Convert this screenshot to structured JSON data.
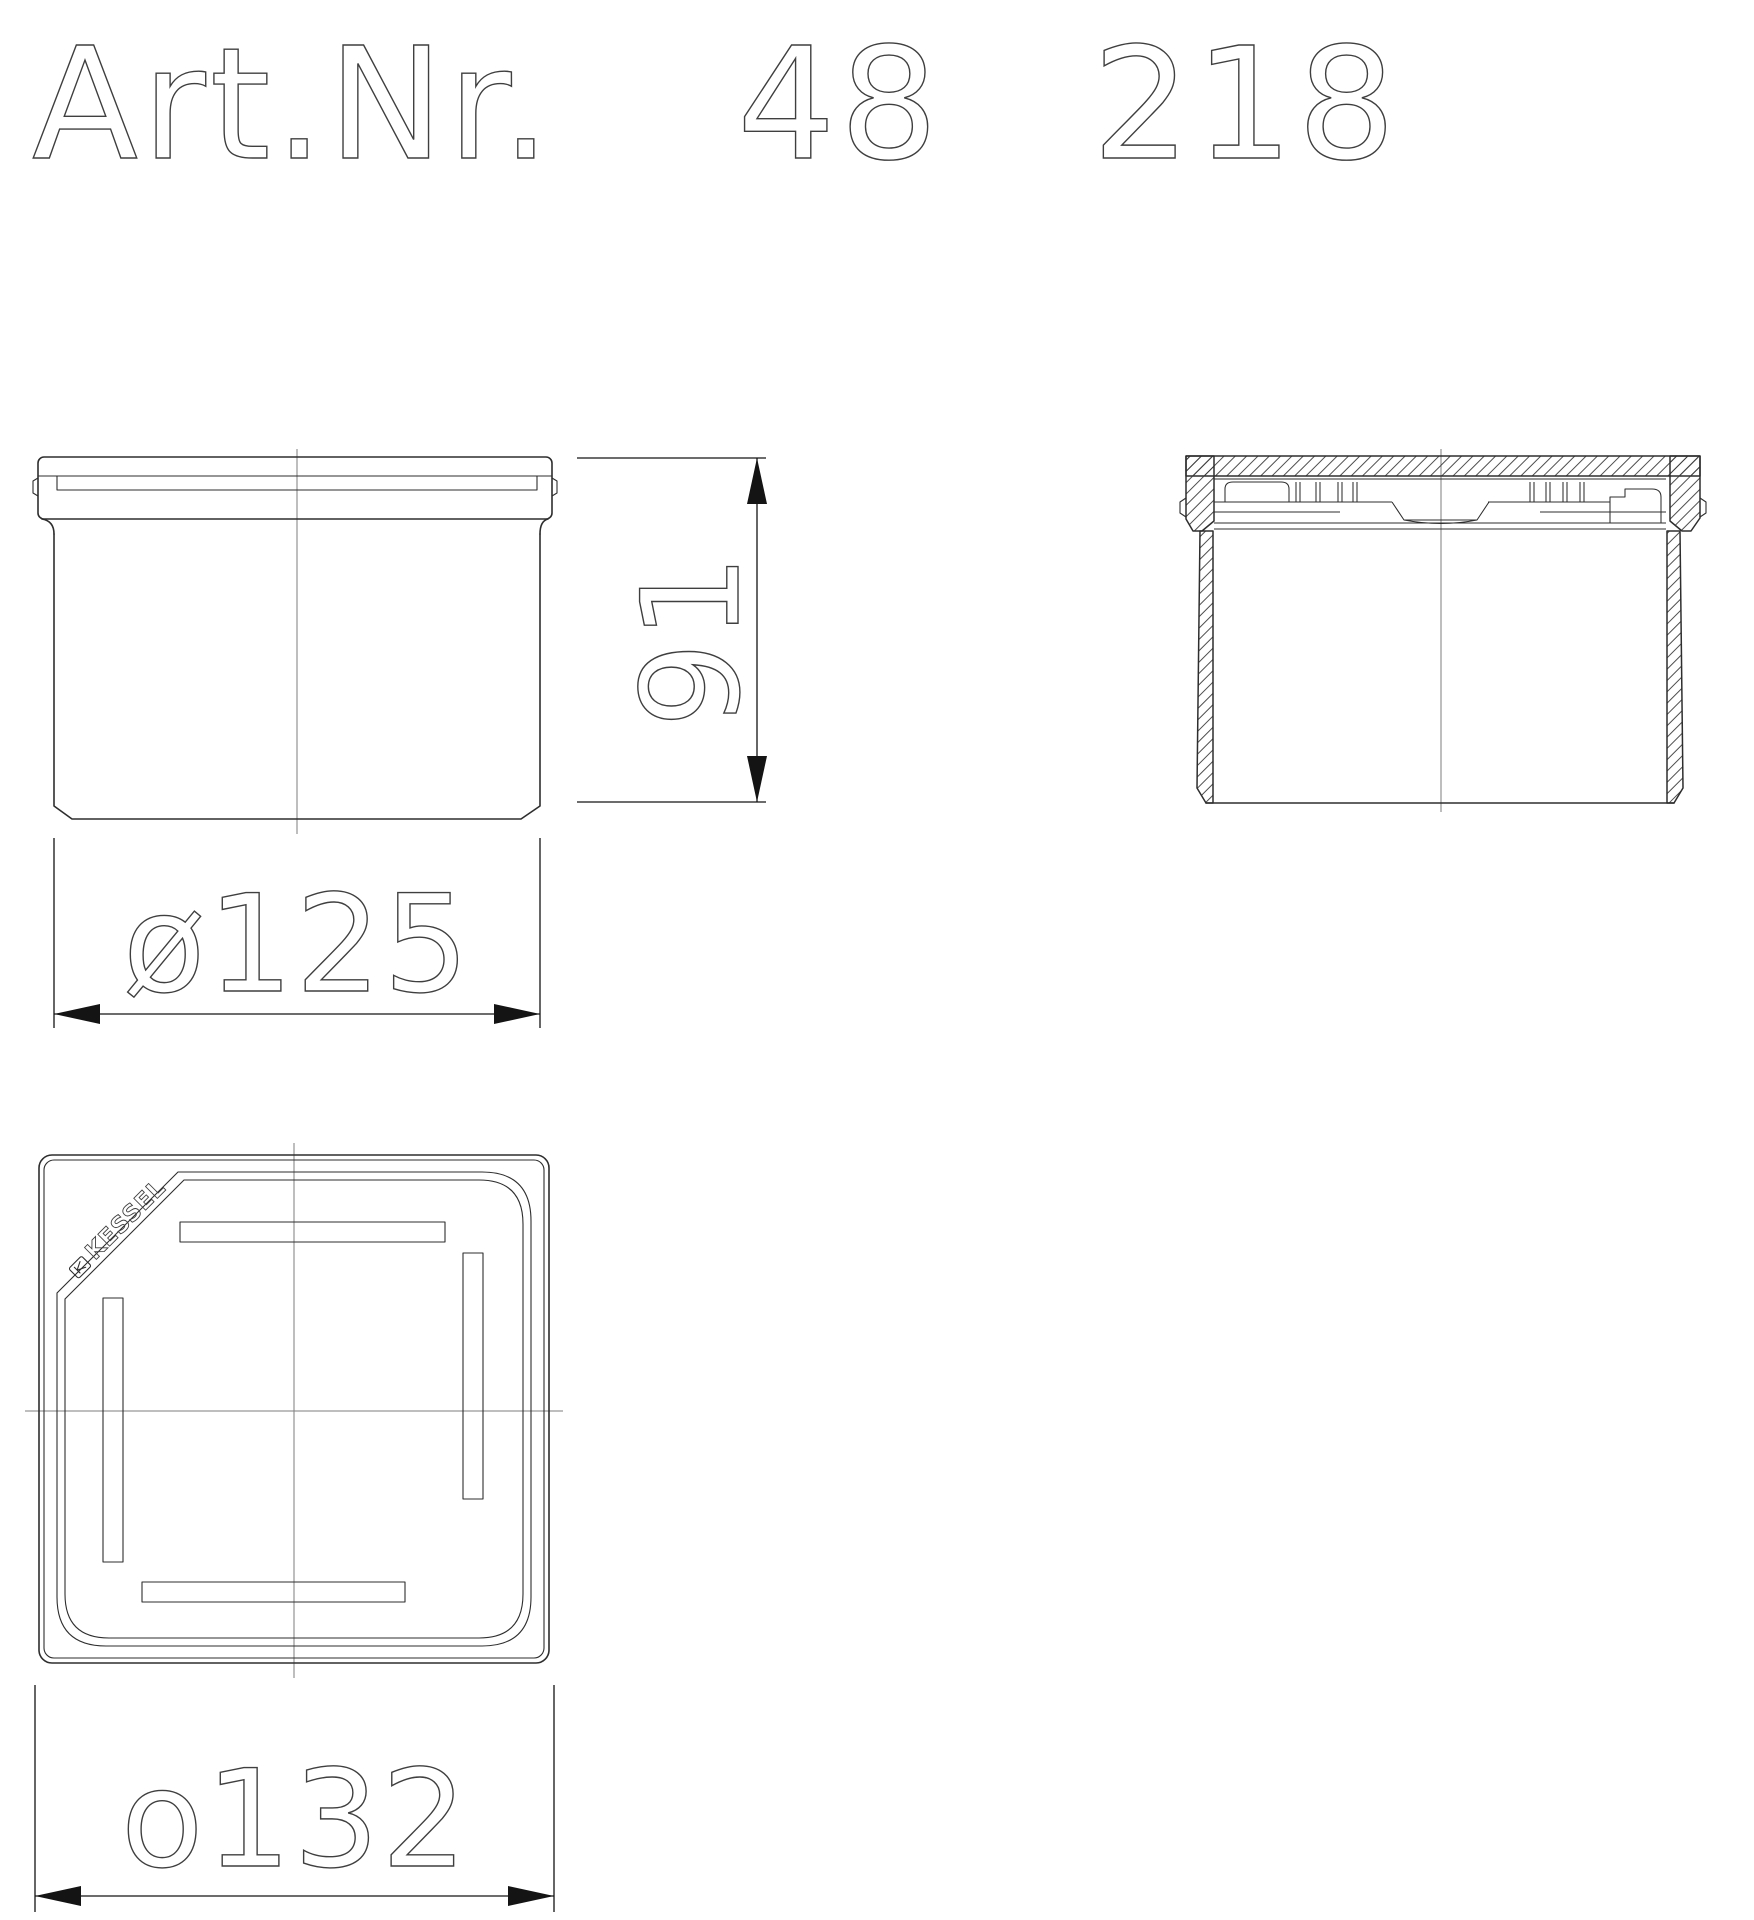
{
  "title": {
    "label": "Art.Nr.",
    "number_left": "48",
    "number_right": "218",
    "full_number": "48 218"
  },
  "dimensions": {
    "body_diameter": "ø125",
    "height": "91",
    "plate_width": "o132"
  },
  "top_view": {
    "logo": "KESSEL"
  },
  "colors": {
    "background": "#ffffff",
    "line": "#2e2e2e",
    "center_line": "#7d7d7d",
    "dimension": "#141414",
    "text_outline": "#3f3f3f"
  }
}
